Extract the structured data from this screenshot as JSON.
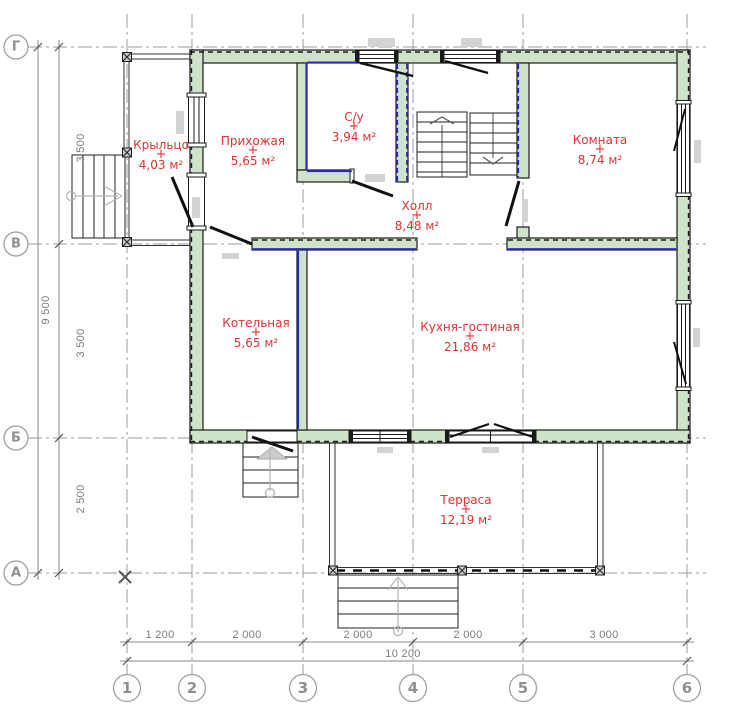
{
  "drawing": {
    "type": "floor-plan",
    "room_marker": "+",
    "colors": {
      "wall_fill": "#cfe3c8",
      "wall_stroke": "#1c1c1c",
      "vapor_barrier_blue": "#2929cf",
      "room_label_red": "#e03232",
      "axis_grey": "#9b9b9b",
      "dim_grey": "#7d7d7d",
      "lintel_grey": "#d3d3d3"
    }
  },
  "rooms": [
    {
      "name": "Крыльцо",
      "area": "4,03 м²"
    },
    {
      "name": "Прихожая",
      "area": "5,65 м²"
    },
    {
      "name": "С/у",
      "area": "3,94 м²"
    },
    {
      "name": "Комната",
      "area": "8,74 м²"
    },
    {
      "name": "Холл",
      "area": "8,48 м²"
    },
    {
      "name": "Котельная",
      "area": "5,65 м²"
    },
    {
      "name": "Кухня-гостиная",
      "area": "21,86 м²"
    },
    {
      "name": "Терраса",
      "area": "12,19 м²"
    }
  ],
  "axes": {
    "rows": [
      {
        "label": "Г"
      },
      {
        "label": "В"
      },
      {
        "label": "Б"
      },
      {
        "label": "А"
      }
    ],
    "cols": [
      {
        "label": "1"
      },
      {
        "label": "2"
      },
      {
        "label": "3"
      },
      {
        "label": "4"
      },
      {
        "label": "5"
      },
      {
        "label": "6"
      }
    ]
  },
  "dimensions": {
    "left": {
      "segments": [
        "3 500",
        "3 500",
        "2 500"
      ],
      "overall": "9 500"
    },
    "bottom": {
      "segments": [
        "1 200",
        "2 000",
        "2 000",
        "2 000",
        "3 000"
      ],
      "overall": "10 200"
    }
  }
}
